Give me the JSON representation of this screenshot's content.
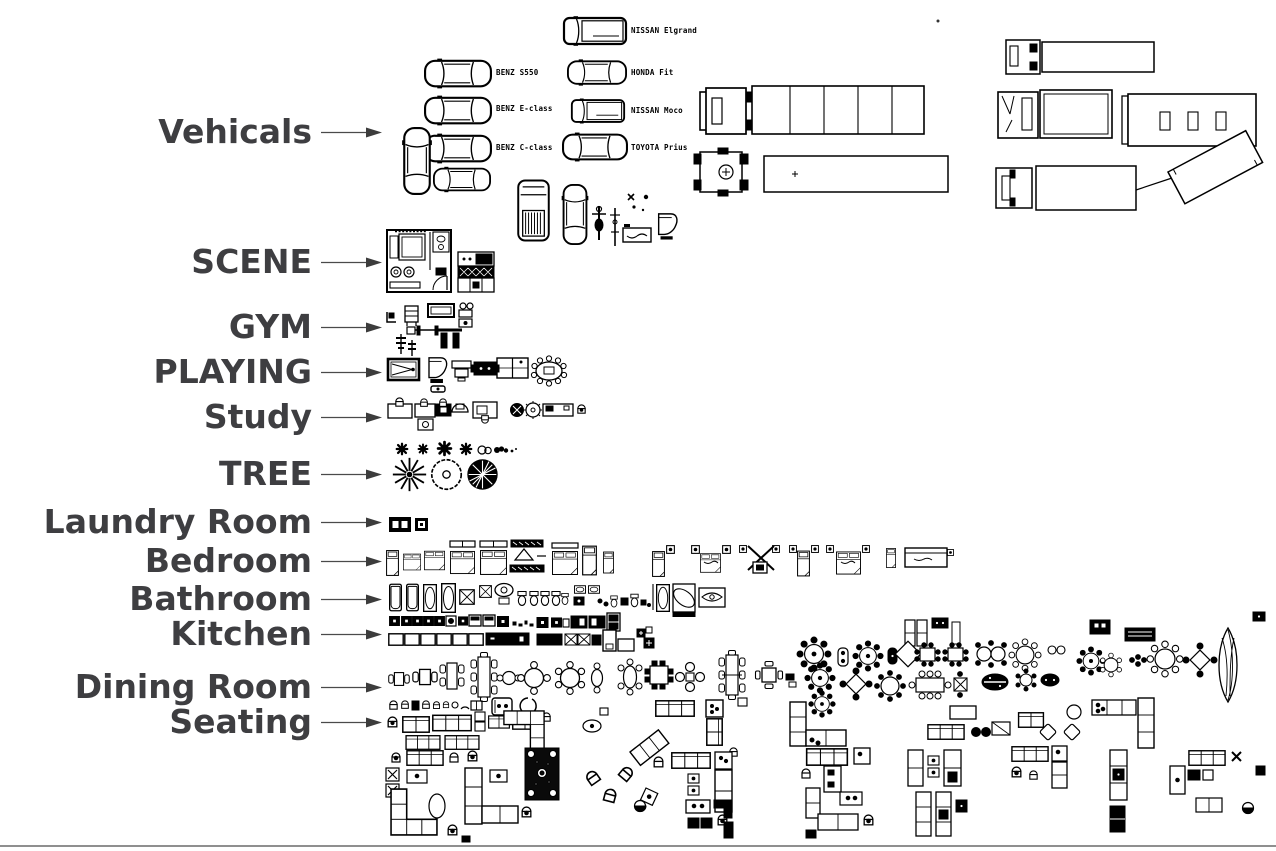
{
  "page": {
    "colors": {
      "background": "#ffffff",
      "ink": "#000000",
      "label_color": "#3e3e41",
      "arrow_color": "#3c3c3c",
      "bottom_rule_color": "#8f8f8f"
    }
  },
  "categories": [
    {
      "label": "Vehicals"
    },
    {
      "label": "SCENE"
    },
    {
      "label": "GYM"
    },
    {
      "label": "PLAYING"
    },
    {
      "label": "Study"
    },
    {
      "label": "TREE"
    },
    {
      "label": "Laundry Room"
    },
    {
      "label": "Bedroom"
    },
    {
      "label": "Bathroom"
    },
    {
      "label": "Kitchen"
    },
    {
      "label": "Dining Room"
    },
    {
      "label": "Seating"
    }
  ],
  "vehicles": {
    "models": [
      "BENZ S550",
      "BENZ E-class",
      "BENZ C-class",
      "NISSAN Elgrand",
      "HONDA Fit",
      "NISSAN Moco",
      "TOYOTA Prius"
    ]
  }
}
